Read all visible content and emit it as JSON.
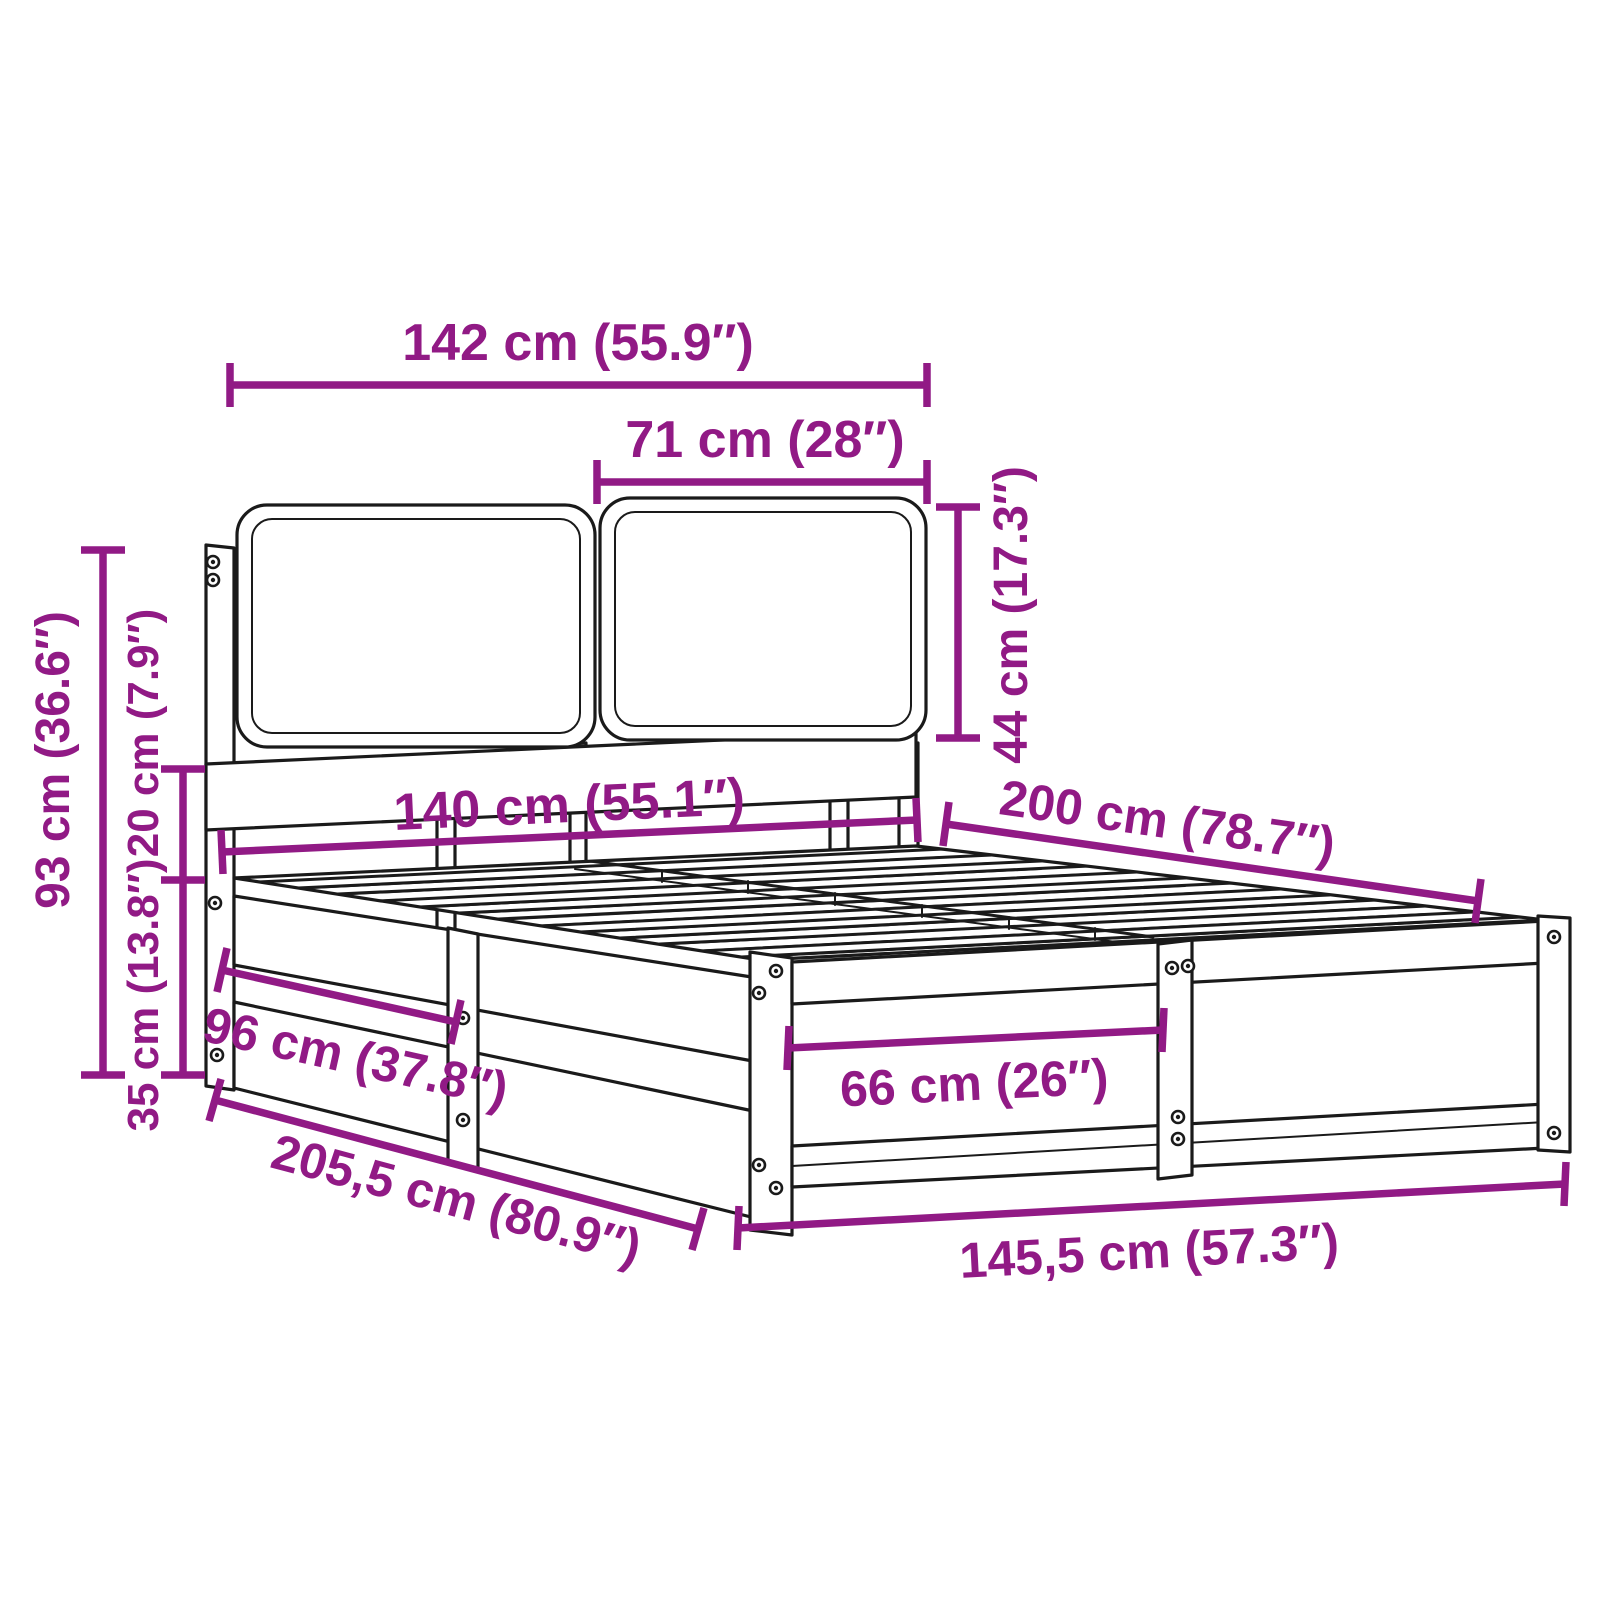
{
  "diagram": {
    "title": "Bed frame with cushioned headboard — dimension diagram",
    "accent_color": "#911A85",
    "ink_color": "#1a1a1a",
    "background_color": "#ffffff",
    "units": "cm / inches",
    "dimensions": {
      "headboard_width": {
        "label": "142 cm (55.9″)",
        "cm": "142",
        "inches": "55.9"
      },
      "cushion_width": {
        "label": "71 cm (28″)",
        "cm": "71",
        "inches": "28"
      },
      "cushion_height": {
        "label": "44 cm (17.3″)",
        "cm": "44",
        "inches": "17.3"
      },
      "total_height": {
        "label": "93 cm (36.6″)",
        "cm": "93",
        "inches": "36.6"
      },
      "headboard_above_deck": {
        "label": "20 cm (7.9″)",
        "cm": "20",
        "inches": "7.9"
      },
      "frame_height": {
        "label": "35 cm (13.8″)",
        "cm": "35",
        "inches": "13.8"
      },
      "mattress_width": {
        "label": "140 cm (55.1″)",
        "cm": "140",
        "inches": "55.1"
      },
      "mattress_length": {
        "label": "200 cm (78.7″)",
        "cm": "200",
        "inches": "78.7"
      },
      "side_rail_section": {
        "label": "96 cm (37.8″)",
        "cm": "96",
        "inches": "37.8"
      },
      "foot_rail_section": {
        "label": "66 cm (26″)",
        "cm": "66",
        "inches": "26"
      },
      "overall_length": {
        "label": "205,5 cm (80.9″)",
        "cm": "205,5",
        "inches": "80.9"
      },
      "overall_width": {
        "label": "145,5 cm (57.3″)",
        "cm": "145,5",
        "inches": "57.3"
      }
    }
  }
}
